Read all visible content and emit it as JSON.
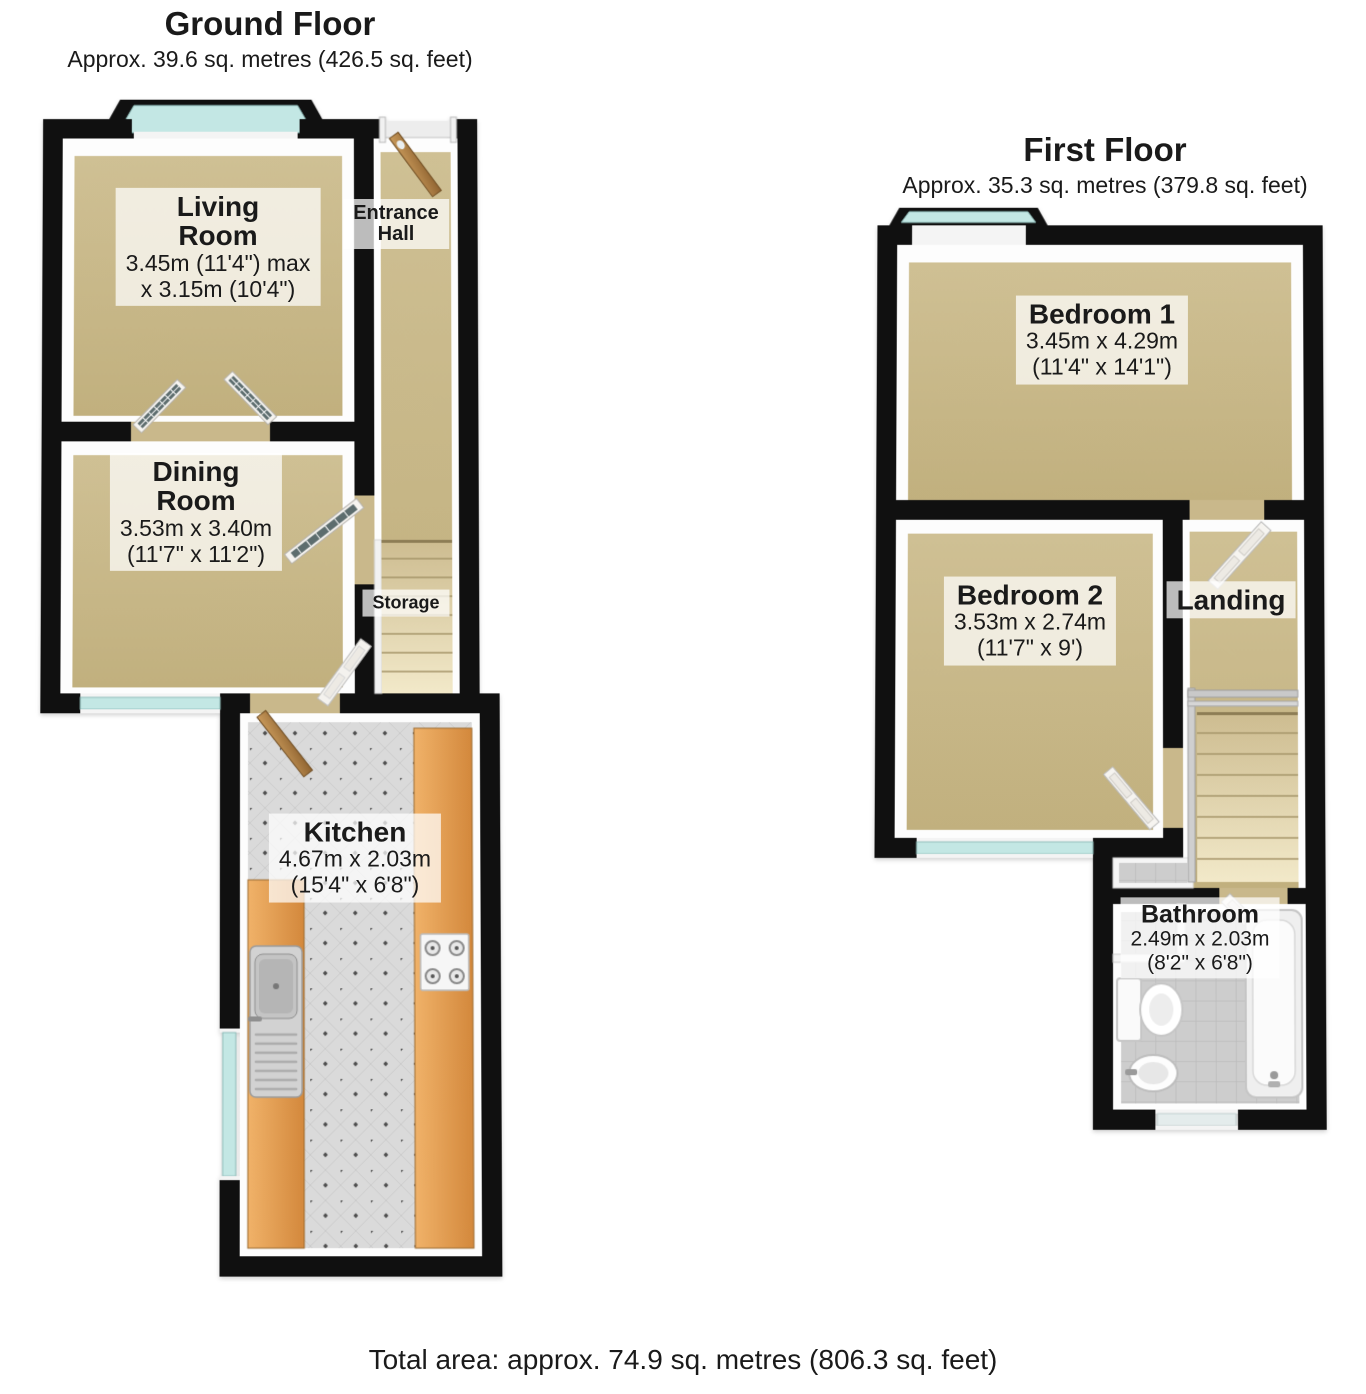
{
  "ground_floor": {
    "title": "Ground Floor",
    "subtitle": "Approx. 39.6 sq. metres (426.5 sq. feet)",
    "rooms": {
      "living_room": {
        "name": "Living\nRoom",
        "dims_line1": "3.45m (11'4\") max",
        "dims_line2": "x 3.15m (10'4\")"
      },
      "entrance_hall": {
        "name": "Entrance\nHall"
      },
      "dining_room": {
        "name": "Dining\nRoom",
        "dims_line1": "3.53m x 3.40m",
        "dims_line2": "(11'7\" x 11'2\")"
      },
      "storage": {
        "name": "Storage"
      },
      "kitchen": {
        "name": "Kitchen",
        "dims_line1": "4.67m x 2.03m",
        "dims_line2": "(15'4\" x 6'8\")"
      }
    }
  },
  "first_floor": {
    "title": "First Floor",
    "subtitle": "Approx. 35.3 sq. metres (379.8 sq. feet)",
    "rooms": {
      "bedroom_1": {
        "name": "Bedroom 1",
        "dims_line1": "3.45m x 4.29m",
        "dims_line2": "(11'4\" x 14'1\")"
      },
      "bedroom_2": {
        "name": "Bedroom 2",
        "dims_line1": "3.53m x 2.74m",
        "dims_line2": "(11'7\" x 9')"
      },
      "landing": {
        "name": "Landing"
      },
      "bathroom": {
        "name": "Bathroom",
        "dims_line1": "2.49m x 2.03m",
        "dims_line2": "(8'2\" x 6'8\")"
      }
    }
  },
  "footer": {
    "total_area": "Total area: approx. 74.9 sq. metres (806.3 sq. feet)"
  },
  "colors": {
    "wall": "#101010",
    "carpet": "#c9b88b",
    "window_glass": "#c3e7e4",
    "kitchen_tile": "#dadada",
    "bathroom_tile": "#cdcdcd",
    "counter_wood": "#e2974b",
    "door_wood": "#b5854b",
    "fixture_white": "#f4f4f4",
    "label_background": "rgba(255,255,255,0.72)",
    "text": "#1a1a1a"
  }
}
